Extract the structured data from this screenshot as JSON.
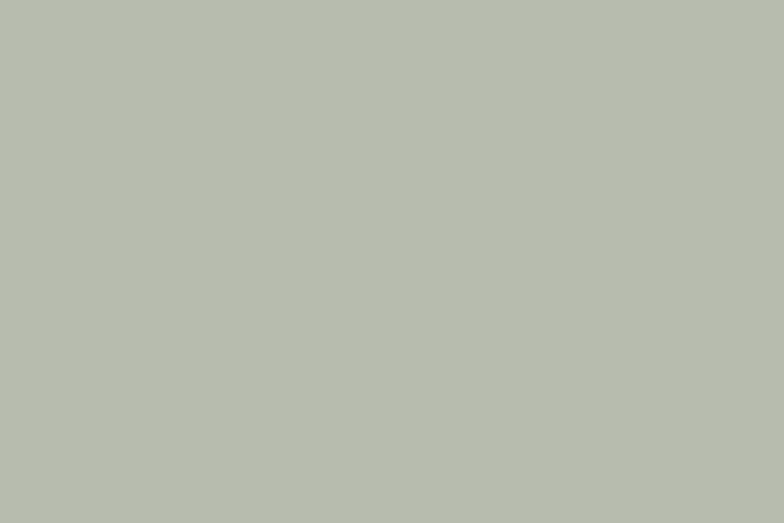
{
  "meta": {
    "title": "Aerial rendering of a desert-edge master-planned villa community beside a highway"
  },
  "scene": {
    "regions": [
      {
        "name": "city-skyline",
        "desc": "hazy high-rise skyline strip along the top"
      },
      {
        "name": "desert",
        "desc": "open sand flats upper right with shadow patches and scrub"
      },
      {
        "name": "city-west",
        "desc": "apartment towers and street grid left of the highway"
      },
      {
        "name": "highway",
        "desc": "multi-lane highway curving down the left side with traffic"
      },
      {
        "name": "villa-community",
        "desc": "concentric curved rows of white villas with parks and a lake"
      },
      {
        "name": "commercial-strip",
        "desc": "dark flat-roofed office blocks with pools along the southwest edge"
      },
      {
        "name": "clubhouse",
        "desc": "large angular clubhouse with green roof, pools and parking at the east tip"
      },
      {
        "name": "boulevard",
        "desc": "tree-lined arterial road across the bottom and up the east side"
      },
      {
        "name": "terrain-southeast",
        "desc": "dark undeveloped scrubland with brown patches"
      },
      {
        "name": "terrain-southwest",
        "desc": "rocky dark ground at bottom left"
      }
    ]
  },
  "palette": {
    "cityBase": "#b4baac",
    "desert": "#cec09c",
    "desertLight": "#dccfab",
    "desertShadow": "#8d8974",
    "scrub": "#6f6a52",
    "skylineBack": "#d3dade",
    "skyline1": "#c3cbd1",
    "skyline2": "#cfd6da",
    "skyline3": "#b4bdc3",
    "skyline4": "#dde2e5",
    "haze": "#eef2f4",
    "road": "#a4a8aa",
    "highway": "#adb0b2",
    "laneLine": "#e3e6e7",
    "verge": "#5e7b45",
    "green": "#74894f",
    "greenLight": "#8aa25e",
    "greenDark": "#4f6b38",
    "lawn": "#7ba052",
    "treeDark": "#2d4a27",
    "treeMid": "#3f6230",
    "treeLight": "#557a38",
    "street": "#b9bdb3",
    "villaWall": "#eae8df",
    "villaWall2": "#d9d7cc",
    "villaRoof": "#a3a49e",
    "villaShadow": "#5e6162",
    "water": "#2ba0a2",
    "waterLight": "#5cc3c3",
    "pool": "#31b0b3",
    "darkBuilding": "#383c3e",
    "darkBuildingEdge": "#202427",
    "roofFrame": "#979ea2",
    "plaza": "#cfc9b8",
    "terrain": "#5d6356",
    "terrainMottle": "#6b7162",
    "terrainShade": "#4d5850",
    "dirtBrown": "#7d5b38",
    "dirtLight": "#946f44",
    "rocky": "#45483d",
    "rock": "#8a8c85",
    "orangeLot": "#d7a45b",
    "orangeLotDark": "#b9834a",
    "shadow": "#000000",
    "carColors": [
      "#f5f5f3",
      "#dcddd9",
      "#24262a",
      "#3a3f45",
      "#8c9094",
      "#7d3430",
      "#2e4d6e",
      "#c8c9c5"
    ]
  }
}
